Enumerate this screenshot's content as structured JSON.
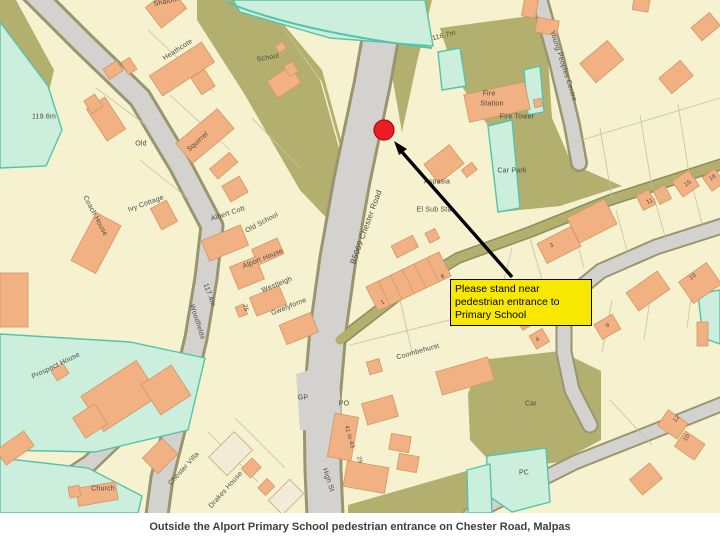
{
  "caption": {
    "text": "Outside the Alport Primary School pedestrian entrance on Chester Road, Malpas"
  },
  "map": {
    "palette": {
      "parcel_cream": "#f6f2d0",
      "building_orange": "#f2b183",
      "vegetation_olive": "#b3af6e",
      "grass_mint": "#cceedd",
      "teal_boundary": "#55c3a9",
      "road_gray": "#d3d2cf",
      "marker_red": "#ed1c24",
      "callout_yellow": "#f8e800"
    },
    "marker": {
      "shape": "circle",
      "x": 384,
      "y": 130
    },
    "arrow": {
      "tail_x": 512,
      "tail_y": 277,
      "tip_x": 394,
      "tip_y": 141
    },
    "annotation": {
      "text": "Please stand near pedestrian entrance to Primary School",
      "x": 450,
      "y": 279
    },
    "labels": [
      {
        "id": "shalom",
        "text": "Shalom",
        "x": 166,
        "y": 2,
        "rot": -12
      },
      {
        "id": "heathcote",
        "text": "Heathcote",
        "x": 178,
        "y": 50,
        "rot": -33
      },
      {
        "id": "height-119",
        "text": "119.6m",
        "x": 44,
        "y": 117,
        "rot": 0
      },
      {
        "id": "old",
        "text": "Old",
        "x": 141,
        "y": 144,
        "rot": 0
      },
      {
        "id": "squirrel",
        "text": "Squirrel",
        "x": 198,
        "y": 142,
        "rot": -42
      },
      {
        "id": "school",
        "text": "School",
        "x": 268,
        "y": 58,
        "rot": -10
      },
      {
        "id": "height-116",
        "text": "116.7m",
        "x": 444,
        "y": 36,
        "rot": -14
      },
      {
        "id": "young-peoples-centre",
        "text": "Young Peoples Centre",
        "x": 563,
        "y": 66,
        "rot": 72
      },
      {
        "id": "fire",
        "text": "Fire",
        "x": 489,
        "y": 94,
        "rot": 0
      },
      {
        "id": "station",
        "text": "Station",
        "x": 492,
        "y": 104,
        "rot": 0
      },
      {
        "id": "fire-tower",
        "text": "Fire Tower",
        "x": 517,
        "y": 117,
        "rot": 0
      },
      {
        "id": "car-park",
        "text": "Car Park",
        "x": 512,
        "y": 171,
        "rot": 0
      },
      {
        "id": "aspasia",
        "text": "Aspasia",
        "x": 437,
        "y": 182,
        "rot": 0
      },
      {
        "id": "el-sub-sta",
        "text": "El Sub Sta",
        "x": 434,
        "y": 210,
        "rot": 0
      },
      {
        "id": "b5069-chester-road",
        "text": "B5069  Chester  Road",
        "x": 366,
        "y": 227,
        "rot": -70,
        "size": 8
      },
      {
        "id": "ivy-cottage",
        "text": "Ivy Cottage",
        "x": 146,
        "y": 204,
        "rot": -20
      },
      {
        "id": "coach-house",
        "text": "Coach House",
        "x": 95,
        "y": 216,
        "rot": 62
      },
      {
        "id": "albert-cott",
        "text": "Albert Cott",
        "x": 228,
        "y": 214,
        "rot": -18
      },
      {
        "id": "old-school",
        "text": "Old School",
        "x": 262,
        "y": 223,
        "rot": -28
      },
      {
        "id": "alport-house",
        "text": "Alport House",
        "x": 263,
        "y": 259,
        "rot": -22
      },
      {
        "id": "westleigh",
        "text": "Westleigh",
        "x": 277,
        "y": 285,
        "rot": -22
      },
      {
        "id": "gwelyforne",
        "text": "Gwelyforne",
        "x": 289,
        "y": 307,
        "rot": -22
      },
      {
        "id": "no-25",
        "text": "25",
        "x": 245,
        "y": 308,
        "rot": 80,
        "size": 6
      },
      {
        "id": "height-117",
        "text": "117.4m",
        "x": 209,
        "y": 295,
        "rot": 70
      },
      {
        "id": "woodfields",
        "text": "Woodfields",
        "x": 197,
        "y": 322,
        "rot": 72
      },
      {
        "id": "prospect-house",
        "text": "Prospect House",
        "x": 56,
        "y": 366,
        "rot": -26
      },
      {
        "id": "church",
        "text": "Church",
        "x": 103,
        "y": 489,
        "rot": 0
      },
      {
        "id": "chester-villa",
        "text": "Chester Villa",
        "x": 184,
        "y": 469,
        "rot": -48
      },
      {
        "id": "drakes-house",
        "text": "Drakes House",
        "x": 226,
        "y": 490,
        "rot": -48
      },
      {
        "id": "gp",
        "text": "GP",
        "x": 303,
        "y": 398,
        "rot": 0
      },
      {
        "id": "po",
        "text": "PO",
        "x": 344,
        "y": 404,
        "rot": 0
      },
      {
        "id": "coombehurst",
        "text": "Coombehurst",
        "x": 418,
        "y": 352,
        "rot": -16
      },
      {
        "id": "no-41-43",
        "text": "41 to 43",
        "x": 349,
        "y": 437,
        "rot": 75,
        "size": 6
      },
      {
        "id": "no-29",
        "text": "29",
        "x": 359,
        "y": 460,
        "rot": 75,
        "size": 6
      },
      {
        "id": "high-st",
        "text": "High St",
        "x": 328,
        "y": 480,
        "rot": 72
      },
      {
        "id": "car",
        "text": "Car",
        "x": 531,
        "y": 404,
        "rot": 0
      },
      {
        "id": "pc",
        "text": "PC",
        "x": 524,
        "y": 473,
        "rot": 0
      },
      {
        "id": "no-1",
        "text": "1",
        "x": 383,
        "y": 303,
        "rot": -25,
        "size": 6
      },
      {
        "id": "no-6",
        "text": "6",
        "x": 443,
        "y": 277,
        "rot": -25,
        "size": 6
      },
      {
        "id": "no-3",
        "text": "3",
        "x": 552,
        "y": 246,
        "rot": -25,
        "size": 6
      },
      {
        "id": "no-11",
        "text": "11",
        "x": 650,
        "y": 202,
        "rot": -25,
        "size": 6
      },
      {
        "id": "no-15",
        "text": "15",
        "x": 688,
        "y": 184,
        "rot": -35,
        "size": 6
      },
      {
        "id": "no-16",
        "text": "16",
        "x": 713,
        "y": 178,
        "rot": -35,
        "size": 6
      },
      {
        "id": "no-10a",
        "text": "10",
        "x": 693,
        "y": 277,
        "rot": -35,
        "size": 6
      },
      {
        "id": "no-9",
        "text": "9",
        "x": 608,
        "y": 326,
        "rot": -30,
        "size": 6
      },
      {
        "id": "no-4",
        "text": "4",
        "x": 538,
        "y": 340,
        "rot": -30,
        "size": 6
      },
      {
        "id": "no-12",
        "text": "12",
        "x": 677,
        "y": 419,
        "rot": -55,
        "size": 6
      },
      {
        "id": "no-10b",
        "text": "10",
        "x": 687,
        "y": 438,
        "rot": -55,
        "size": 6
      }
    ]
  }
}
